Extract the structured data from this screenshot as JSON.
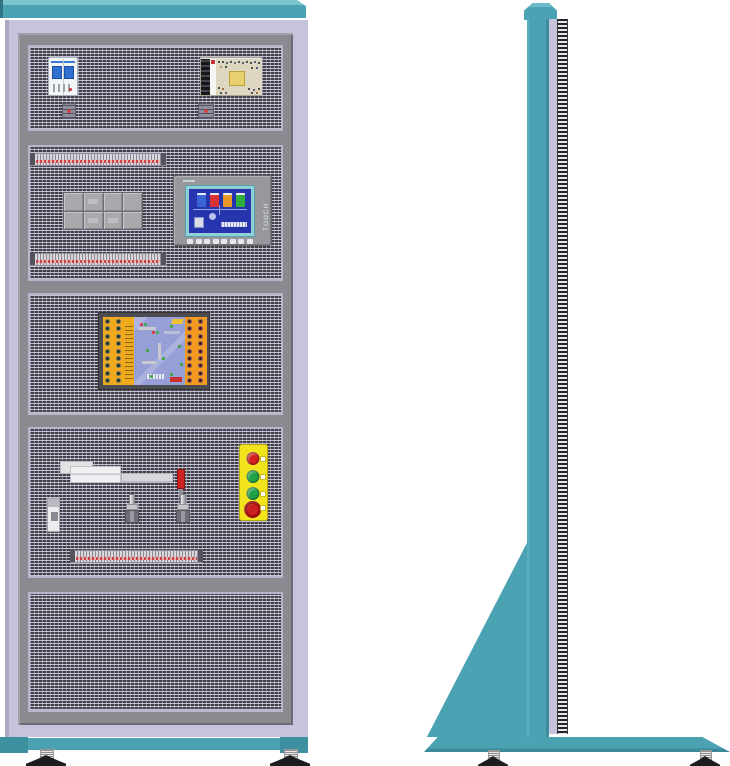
{
  "illustration": {
    "subject": "electrical-training-cabinet",
    "views": [
      "front-view",
      "side-view"
    ]
  },
  "colors": {
    "teal": "#4aa2b2",
    "teal_light": "#7cc4ce",
    "teal_dark": "#3e8c9d",
    "lavender": "#c6c4dc",
    "frame_gray": "#8a8a90",
    "panel_dark": "#3f3e45",
    "panel_mesh": "#c9c7db",
    "strip_red": "#cc4444",
    "screen_blue": "#2634ae",
    "screen_border_teal": "#8fd0d8"
  },
  "front": {
    "section1": [
      "circuit-breaker",
      "power-supply",
      "terminal-block",
      "terminal-block"
    ],
    "section2": [
      "terminal-strip",
      "relay-group",
      "hmi-panel",
      "terminal-strip"
    ],
    "section3": [
      "plc-trainer-board"
    ],
    "section4": [
      "pneumatic-cylinder",
      "red-lever",
      "toggle-switch",
      "toggle-switch",
      "mini-breaker",
      "push-button-station",
      "terminal-strip"
    ],
    "section5": []
  },
  "hmi": {
    "touch_label": "TOUCH",
    "screen_tanks": [
      "#3b63d8",
      "#d83232",
      "#e89a28",
      "#2fae3e"
    ],
    "function_keys": 8
  },
  "relay_group": {
    "rows": 2,
    "cols": 4
  },
  "plc": {
    "dot_rows": 9,
    "left_dot_color": "#23321f",
    "right_dot_color": "#4a1414",
    "left_panel_color": "#f0a81c",
    "right_panel_color": "#f59a20"
  },
  "button_station": {
    "panel_color": "#f2e41c",
    "buttons": [
      {
        "name": "red-pushbutton",
        "color": "#d42020",
        "type": "round"
      },
      {
        "name": "green-pushbutton-1",
        "color": "#1fa046",
        "type": "round"
      },
      {
        "name": "green-pushbutton-2",
        "color": "#1fa046",
        "type": "round"
      },
      {
        "name": "emergency-stop-button",
        "color": "#cc1f1f",
        "type": "mushroom"
      }
    ]
  }
}
